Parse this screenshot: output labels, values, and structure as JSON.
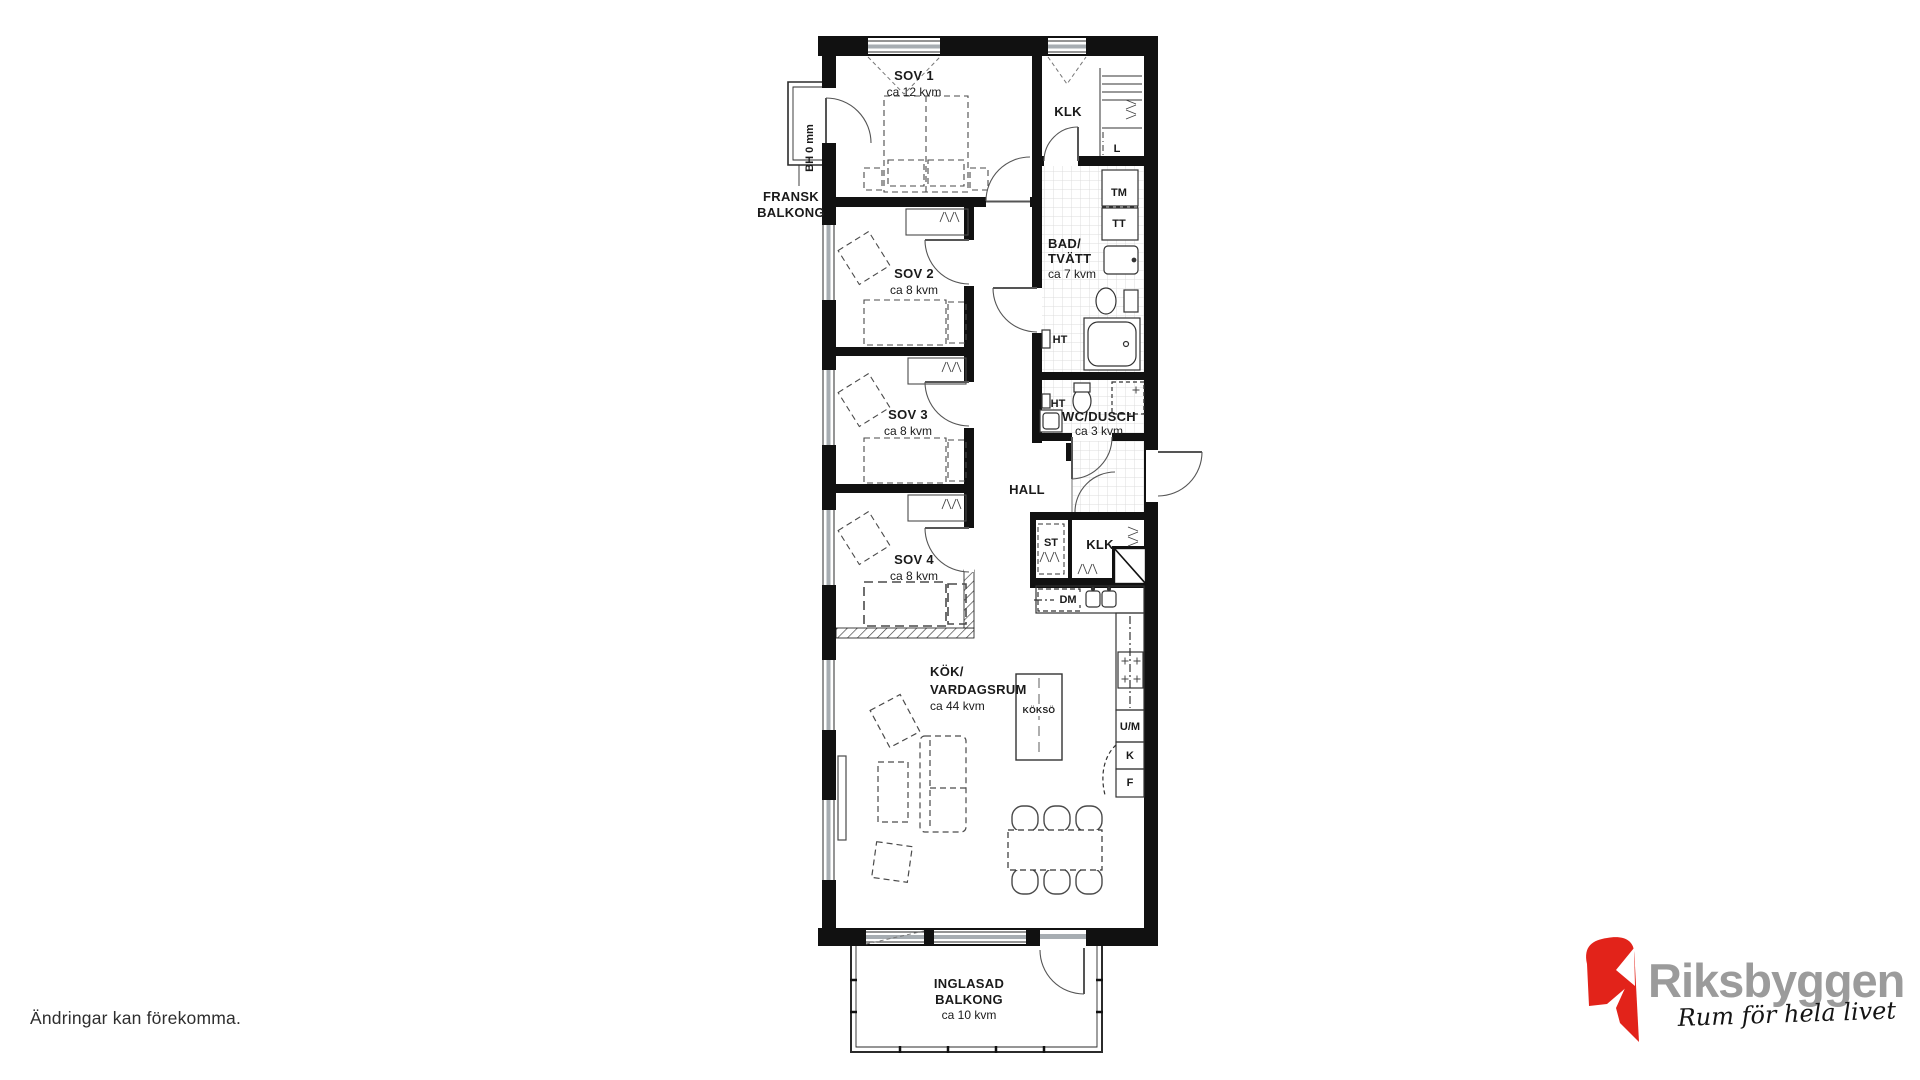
{
  "disclaimer": "Ändringar kan förekomma.",
  "logo": {
    "brand": "Riksbyggen",
    "tagline": "Rum för hela livet"
  },
  "colors": {
    "wall": "#111111",
    "line": "#555555",
    "logo_red": "#e2231a",
    "logo_gray": "#9b9b9b"
  },
  "rooms": {
    "sov1": {
      "name": "SOV 1",
      "area": "ca 12 kvm"
    },
    "sov2": {
      "name": "SOV 2",
      "area": "ca 8 kvm"
    },
    "sov3": {
      "name": "SOV 3",
      "area": "ca 8 kvm"
    },
    "sov4": {
      "name": "SOV 4",
      "area": "ca 8 kvm"
    },
    "klk_top": {
      "name": "KLK"
    },
    "bad_tvatt": {
      "name_line1": "BAD/",
      "name_line2": "TVÄTT",
      "area": "ca 7 kvm"
    },
    "wc_dusch": {
      "name": "WC/DUSCH",
      "area": "ca 3 kvm"
    },
    "hall": {
      "name": "HALL"
    },
    "st": {
      "name": "ST"
    },
    "klk_mid": {
      "name": "KLK"
    },
    "kok": {
      "name_line1": "KÖK/",
      "name_line2": "VARDAGSRUM",
      "area": "ca 44 kvm"
    },
    "koksso": {
      "name": "KÖKSÖ"
    },
    "inglasad_balkong": {
      "name_line1": "INGLASAD",
      "name_line2": "BALKONG",
      "area": "ca 10 kvm"
    },
    "fransk_balkong": {
      "name_line1": "FRANSK",
      "name_line2": "BALKONG"
    }
  },
  "fixtures": {
    "l": "L",
    "tm": "TM",
    "tt": "TT",
    "ht_bad": "HT",
    "ht_wc": "HT",
    "dm": "DM",
    "um": "U/M",
    "kyl": "K",
    "frys": "F",
    "bh": "BH 0 mm"
  }
}
